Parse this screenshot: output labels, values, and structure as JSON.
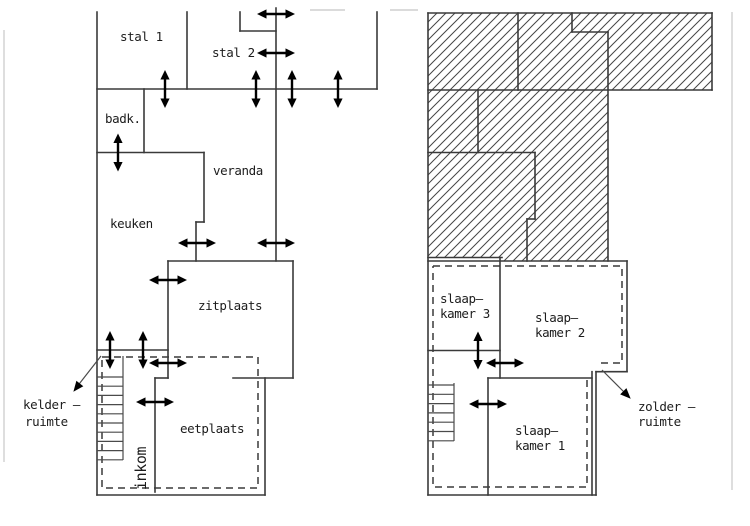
{
  "drawing": {
    "kind": "house floor plans, two storeys",
    "colors": {
      "background": "#ffffff",
      "line": "#3a3a3a",
      "arrow": "#000000",
      "text": "#1c1c1c",
      "page_edge": "#cfcfcf"
    },
    "ground_floor": {
      "rooms": {
        "stal_1": "stal 1",
        "stal_2": "stal 2",
        "badkamer": "badk.",
        "veranda": "veranda",
        "keuken": "keuken",
        "zitplaats": "zitplaats",
        "eetplaats": "eetplaats",
        "inkom": "inkom"
      },
      "callout": {
        "line1": "kelder –",
        "line2": "ruimte"
      }
    },
    "upper_floor": {
      "rooms": {
        "slaapkamer_3_line1": "slaap–",
        "slaapkamer_3_line2": "kamer 3",
        "slaapkamer_2_line1": "slaap–",
        "slaapkamer_2_line2": "kamer 2",
        "slaapkamer_1_line1": "slaap–",
        "slaapkamer_1_line2": "kamer 1"
      },
      "callout": {
        "line1": "zolder –",
        "line2": "ruimte"
      }
    }
  }
}
